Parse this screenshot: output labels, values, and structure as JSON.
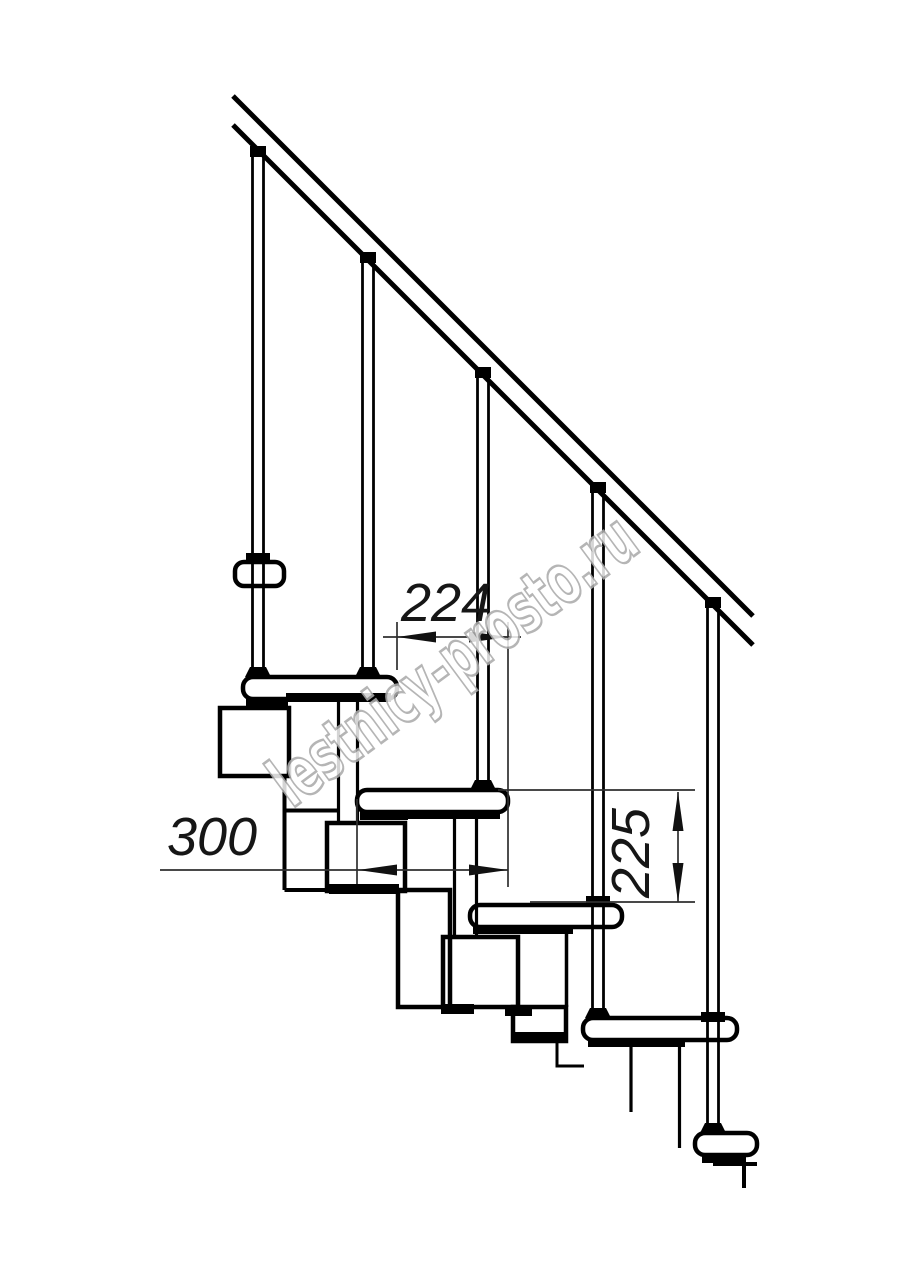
{
  "drawing": {
    "dimensions": {
      "going": {
        "value": "224",
        "orientation": "horizontal"
      },
      "module": {
        "value": "300",
        "orientation": "horizontal"
      },
      "riser": {
        "value": "225",
        "orientation": "vertical"
      }
    },
    "watermark": {
      "text": "lestnicy-prosto.ru",
      "color": "#ababab"
    },
    "colors": {
      "ink": "#000000",
      "dimension_lines": "#2f2f2f",
      "background": "#ffffff"
    }
  }
}
